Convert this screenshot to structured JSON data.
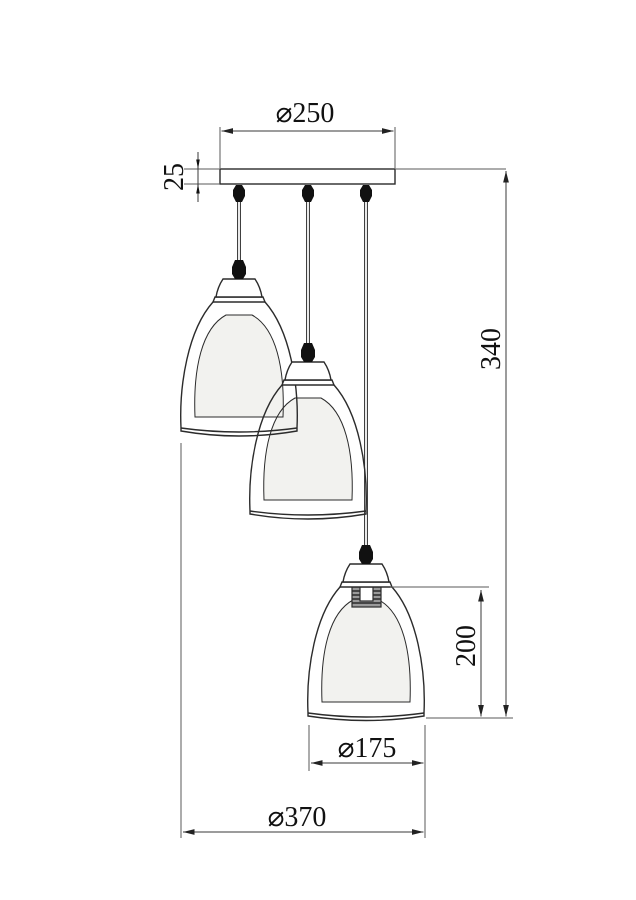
{
  "drawing": {
    "title": "3-light pendant lamp dimension drawing",
    "background": "#ffffff",
    "object_line_color": "#2b2b2b",
    "dimension_line_color": "#3a3a3a",
    "text_color": "#111111",
    "inner_shade_fill": "#f2f2ef",
    "labels": {
      "canopy_diameter": "⌀250",
      "canopy_thickness": "25",
      "suspension_height": "340",
      "shade_height": "200",
      "shade_diameter": "⌀175",
      "fixture_diameter": "⌀370"
    }
  }
}
